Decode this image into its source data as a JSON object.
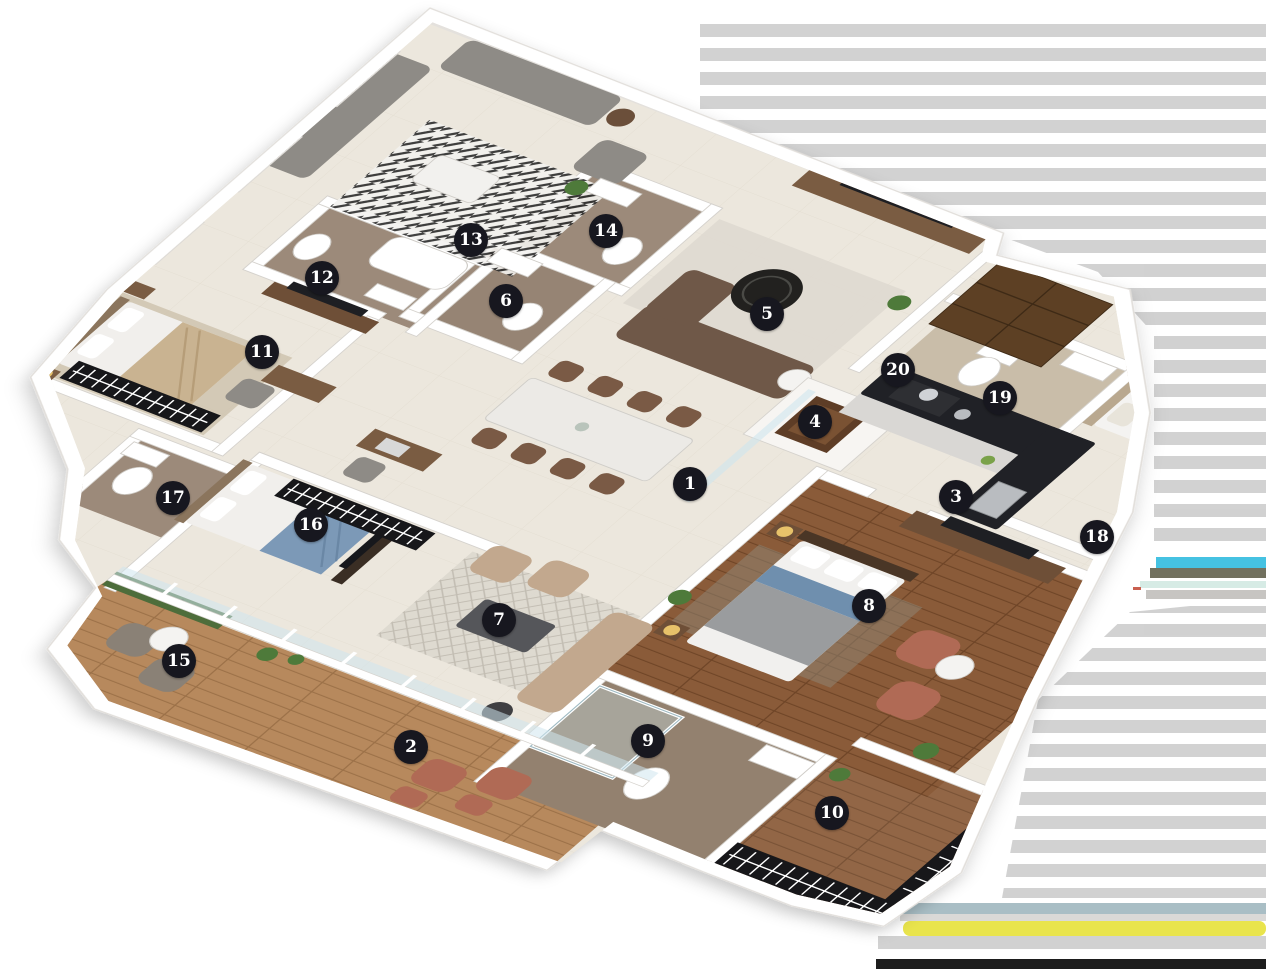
{
  "image": {
    "type": "3d-floor-plan-render",
    "width": 1266,
    "height": 978,
    "background": "#ffffff"
  },
  "floorplan": {
    "marker_style": {
      "bg": "#17171f",
      "text": "#ffffff",
      "diameter": 34
    },
    "markers": [
      {
        "n": "1",
        "x": 690,
        "y": 484
      },
      {
        "n": "2",
        "x": 411,
        "y": 747
      },
      {
        "n": "3",
        "x": 956,
        "y": 497
      },
      {
        "n": "4",
        "x": 815,
        "y": 422
      },
      {
        "n": "5",
        "x": 767,
        "y": 314
      },
      {
        "n": "6",
        "x": 506,
        "y": 301
      },
      {
        "n": "7",
        "x": 499,
        "y": 620
      },
      {
        "n": "8",
        "x": 869,
        "y": 606
      },
      {
        "n": "9",
        "x": 648,
        "y": 741
      },
      {
        "n": "10",
        "x": 832,
        "y": 813
      },
      {
        "n": "11",
        "x": 262,
        "y": 352
      },
      {
        "n": "12",
        "x": 322,
        "y": 278
      },
      {
        "n": "13",
        "x": 471,
        "y": 240
      },
      {
        "n": "14",
        "x": 606,
        "y": 231
      },
      {
        "n": "15",
        "x": 179,
        "y": 661
      },
      {
        "n": "16",
        "x": 311,
        "y": 525
      },
      {
        "n": "17",
        "x": 173,
        "y": 498
      },
      {
        "n": "18",
        "x": 1097,
        "y": 537
      },
      {
        "n": "19",
        "x": 1000,
        "y": 398
      },
      {
        "n": "20",
        "x": 898,
        "y": 370
      }
    ],
    "palette": {
      "wall": "#ffffff",
      "wall_edge": "#d5d2cd",
      "floor_cream": "#ece7dd",
      "wood_dark": "#8a5b39",
      "wood_deck": "#b7895d",
      "marble_bath": "#9c8a7a",
      "counter_black": "#202126",
      "hedge_green": "#4d6d3b",
      "sofa_gray": "#8e8b86",
      "sofa_brown": "#6f5848",
      "sofa_beige": "#c2a88e",
      "chair_terracotta": "#b06a55",
      "bed_blue": "#7c99b7",
      "tv_black": "#1e1f23"
    },
    "edge_artifacts": {
      "stripe_gray": "#c8c8c8",
      "stripe_bluegray": "#a9bec5",
      "stripe_cyan": "#45c2e2",
      "stripe_olive": "#72715f",
      "stripe_pale_teal": "#d6ebe5",
      "stripe_yellow": "#e9e44c",
      "stripe_black": "#1d1d1d"
    }
  }
}
